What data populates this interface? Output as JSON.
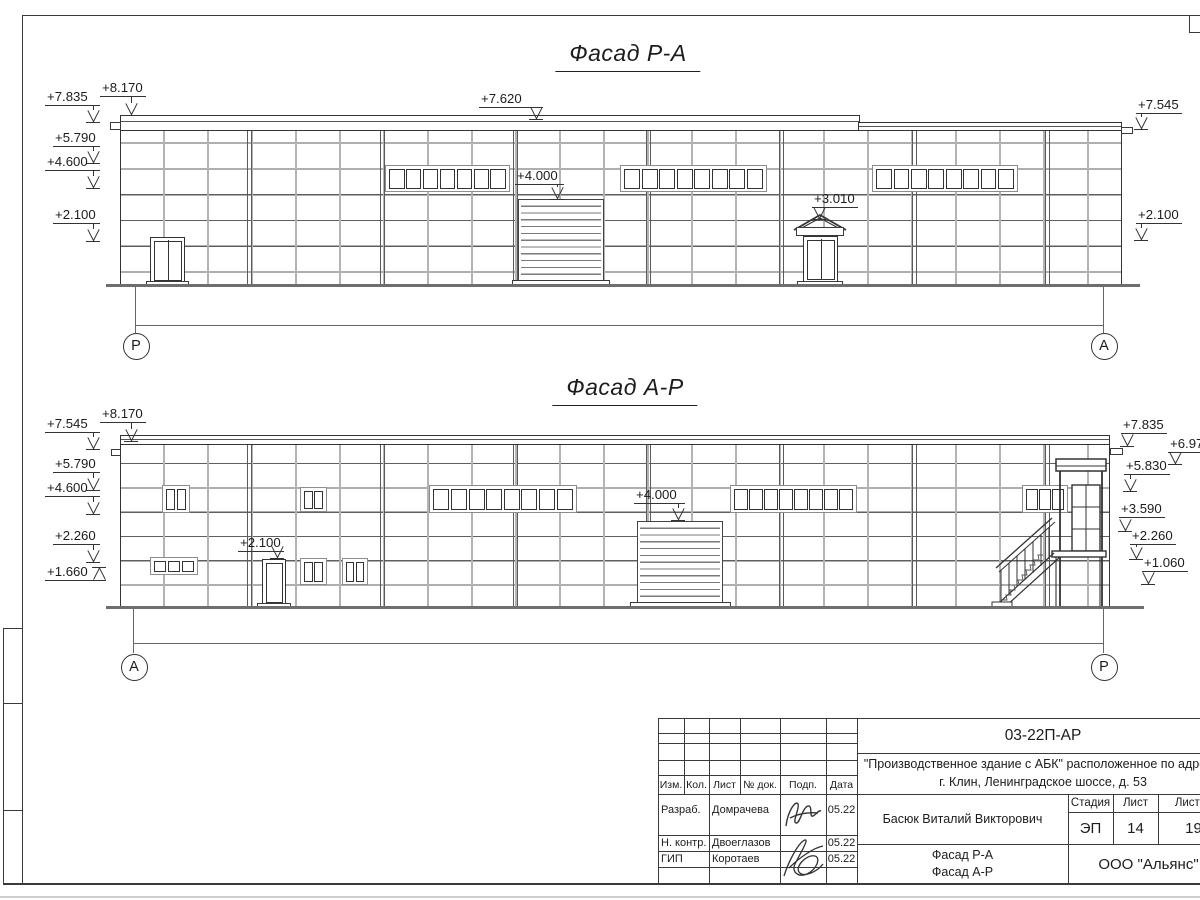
{
  "drawing": {
    "title_top": "Фасад Р-А",
    "title_bottom": "Фасад А-Р",
    "elevation_marks": [
      {
        "label": "+7.835",
        "lx": 45,
        "ly": 90,
        "ax": 93,
        "ay": 122
      },
      {
        "label": "+8.170",
        "lx": 100,
        "ly": 81,
        "ax": 131,
        "ay": 115
      },
      {
        "label": "+5.790",
        "lx": 53,
        "ly": 131,
        "ax": 93,
        "ay": 163
      },
      {
        "label": "+4.600",
        "lx": 45,
        "ly": 155,
        "ax": 93,
        "ay": 188
      },
      {
        "label": "+2.100",
        "lx": 53,
        "ly": 208,
        "ax": 93,
        "ay": 241
      },
      {
        "label": "+7.620",
        "lx": 479,
        "ly": 92,
        "ax": 536,
        "ay": 119
      },
      {
        "label": "+4.000",
        "lx": 515,
        "ly": 169,
        "ax": 557,
        "ay": 199
      },
      {
        "label": "+3.010",
        "lx": 812,
        "ly": 192,
        "ax": 819,
        "ay": 219
      },
      {
        "label": "+7.545",
        "lx": 1136,
        "ly": 98,
        "ax": 1141,
        "ay": 129
      },
      {
        "label": "+2.100",
        "lx": 1136,
        "ly": 208,
        "ax": 1141,
        "ay": 240
      },
      {
        "label": "+7.545",
        "lx": 45,
        "ly": 417,
        "ax": 93,
        "ay": 449
      },
      {
        "label": "+8.170",
        "lx": 100,
        "ly": 407,
        "ax": 131,
        "ay": 441
      },
      {
        "label": "+5.790",
        "lx": 53,
        "ly": 457,
        "ax": 93,
        "ay": 490
      },
      {
        "label": "+4.600",
        "lx": 45,
        "ly": 481,
        "ax": 93,
        "ay": 514
      },
      {
        "label": "+2.260",
        "lx": 53,
        "ly": 529,
        "ax": 93,
        "ay": 562
      },
      {
        "label": "+1.660",
        "lx": 45,
        "ly": 565,
        "ax": 99,
        "ay": 567,
        "dir": "up"
      },
      {
        "label": "+2.100",
        "lx": 238,
        "ly": 536,
        "ax": 277,
        "ay": 558
      },
      {
        "label": "+4.000",
        "lx": 634,
        "ly": 488,
        "ax": 678,
        "ay": 520
      },
      {
        "label": "+7.835",
        "lx": 1121,
        "ly": 418,
        "ax": 1127,
        "ay": 446
      },
      {
        "label": "+6.97",
        "lx": 1168,
        "ly": 437,
        "ax": 1175,
        "ay": 464
      },
      {
        "label": "+5.830",
        "lx": 1124,
        "ly": 459,
        "ax": 1130,
        "ay": 491
      },
      {
        "label": "+3.590",
        "lx": 1119,
        "ly": 502,
        "ax": 1125,
        "ay": 531
      },
      {
        "label": "+2.260",
        "lx": 1130,
        "ly": 529,
        "ax": 1136,
        "ay": 559
      },
      {
        "label": "+1.060",
        "lx": 1142,
        "ly": 556,
        "ax": 1148,
        "ay": 584
      }
    ],
    "axis_bubbles": [
      {
        "label": "Р",
        "x": 135,
        "y": 345
      },
      {
        "label": "А",
        "x": 1103,
        "y": 345
      },
      {
        "label": "А",
        "x": 133,
        "y": 666
      },
      {
        "label": "Р",
        "x": 1103,
        "y": 666
      }
    ]
  },
  "title_block": {
    "doc_number": "03-22П-АР",
    "project_address_line1": "\"Производственное здание с АБК\" расположенное по адресу:",
    "project_address_line2": "г. Клин, Ленинградское шоссе, д. 53",
    "responsible_person": "Басюк Виталий Викторович",
    "revision_headers": [
      "Изм.",
      "Кол.",
      "Лист",
      "№ док.",
      "Подп.",
      "Дата"
    ],
    "signature_rows": [
      {
        "role": "Разраб.",
        "name": "Домрачева",
        "date": "05.22"
      },
      {
        "role": "Н. контр.",
        "name": "Двоеглазов",
        "date": "05.22"
      },
      {
        "role": "ГИП",
        "name": "Коротаев",
        "date": "05.22"
      }
    ],
    "stage_label": "Стадия",
    "stage_value": "ЭП",
    "sheet_label": "Лист",
    "sheet_value": "14",
    "sheets_label": "Листов",
    "sheets_value": "19",
    "drawing_captions": [
      "Фасад Р-А",
      "Фасад А-Р"
    ],
    "company": "ООО \"Альянс\""
  }
}
